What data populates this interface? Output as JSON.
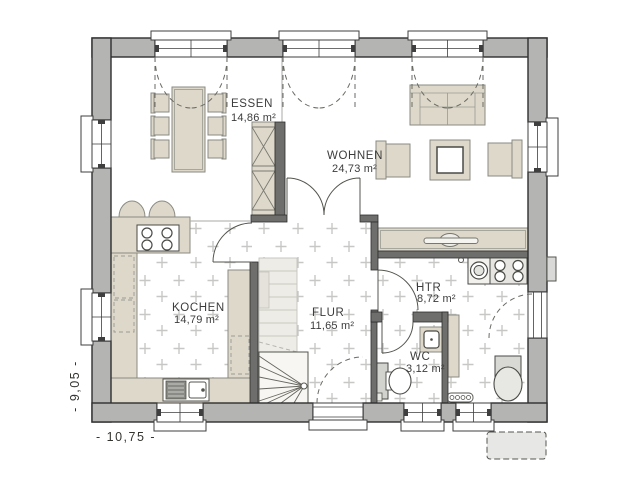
{
  "plan": {
    "title": "floor-plan-ground-floor",
    "rooms": [
      {
        "id": "essen",
        "label": "ESSEN",
        "area": "14,86 m²"
      },
      {
        "id": "wohnen",
        "label": "WOHNEN",
        "area": "24,73 m²"
      },
      {
        "id": "kochen",
        "label": "KOCHEN",
        "area": "14,79 m²"
      },
      {
        "id": "flur",
        "label": "FLUR",
        "area": "11,65 m²"
      },
      {
        "id": "htr",
        "label": "HTR",
        "area": "8,72 m²"
      },
      {
        "id": "wc",
        "label": "WC",
        "area": "3,12 m²"
      }
    ],
    "dimensions": {
      "width_label": "- 10,75 -",
      "height_label": "- 9,05 -"
    },
    "colors": {
      "exterior_wall": "#b4b4b2",
      "interior_wall": "#6e6e6c",
      "furniture": "#ddd8ca",
      "tile_mark": "#c7c7c5",
      "floor": "#ffffff",
      "outline": "#2f2f2f",
      "stair_upper": "#edece6",
      "mat": "#e7e7e5"
    }
  }
}
